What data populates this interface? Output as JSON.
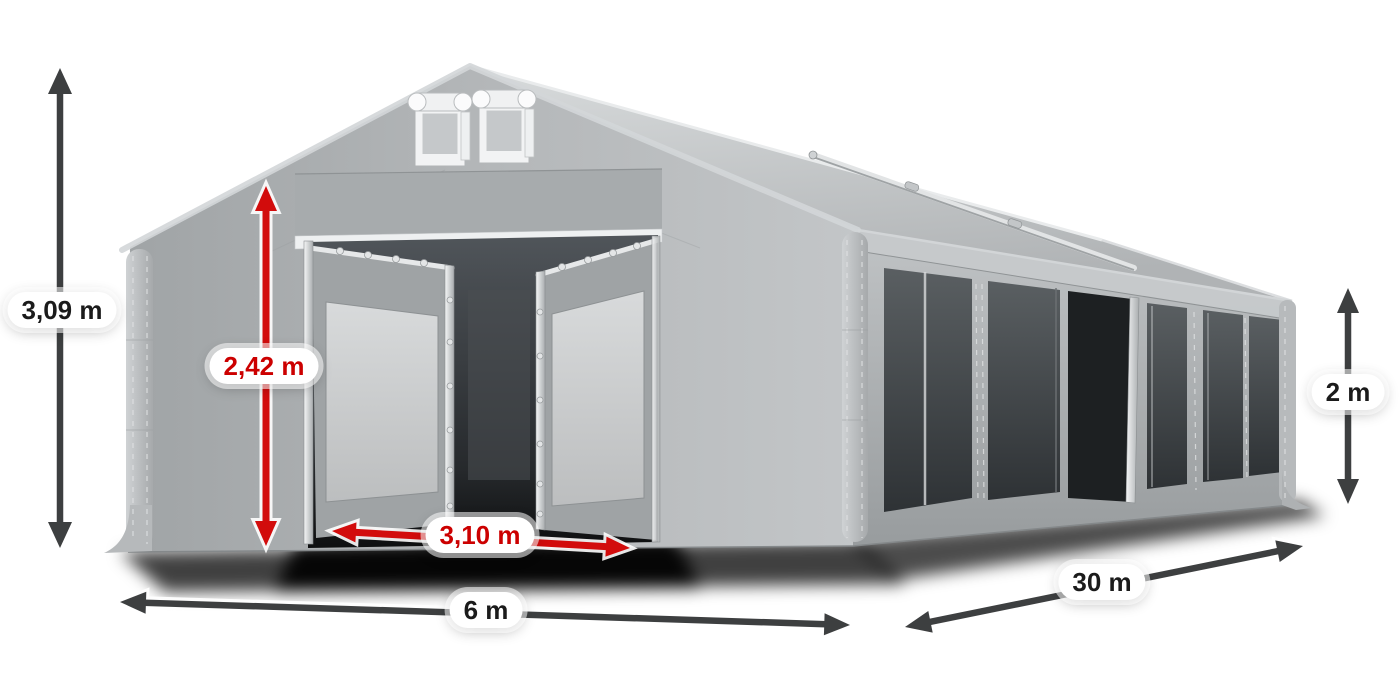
{
  "diagram": {
    "labels": {
      "total_height": {
        "text": "3,09 m",
        "color": "#1b1b1b"
      },
      "entrance_height": {
        "text": "2,42 m",
        "color": "#cc0000"
      },
      "entrance_width": {
        "text": "3,10 m",
        "color": "#cc0000"
      },
      "tent_width": {
        "text": "6 m",
        "color": "#1b1b1b"
      },
      "tent_length": {
        "text": "30 m",
        "color": "#1b1b1b"
      },
      "side_wall_height": {
        "text": "2 m",
        "color": "#1b1b1b"
      }
    },
    "colors": {
      "arrow_dark": "#3d3f40",
      "arrow_red": "#d20c0c",
      "tent_light_gray": "#c3c6c8",
      "tent_mid_gray": "#aeb1b3",
      "window_dark": "#3f4447",
      "label_background": "#ffffff",
      "background": "#ffffff"
    }
  }
}
